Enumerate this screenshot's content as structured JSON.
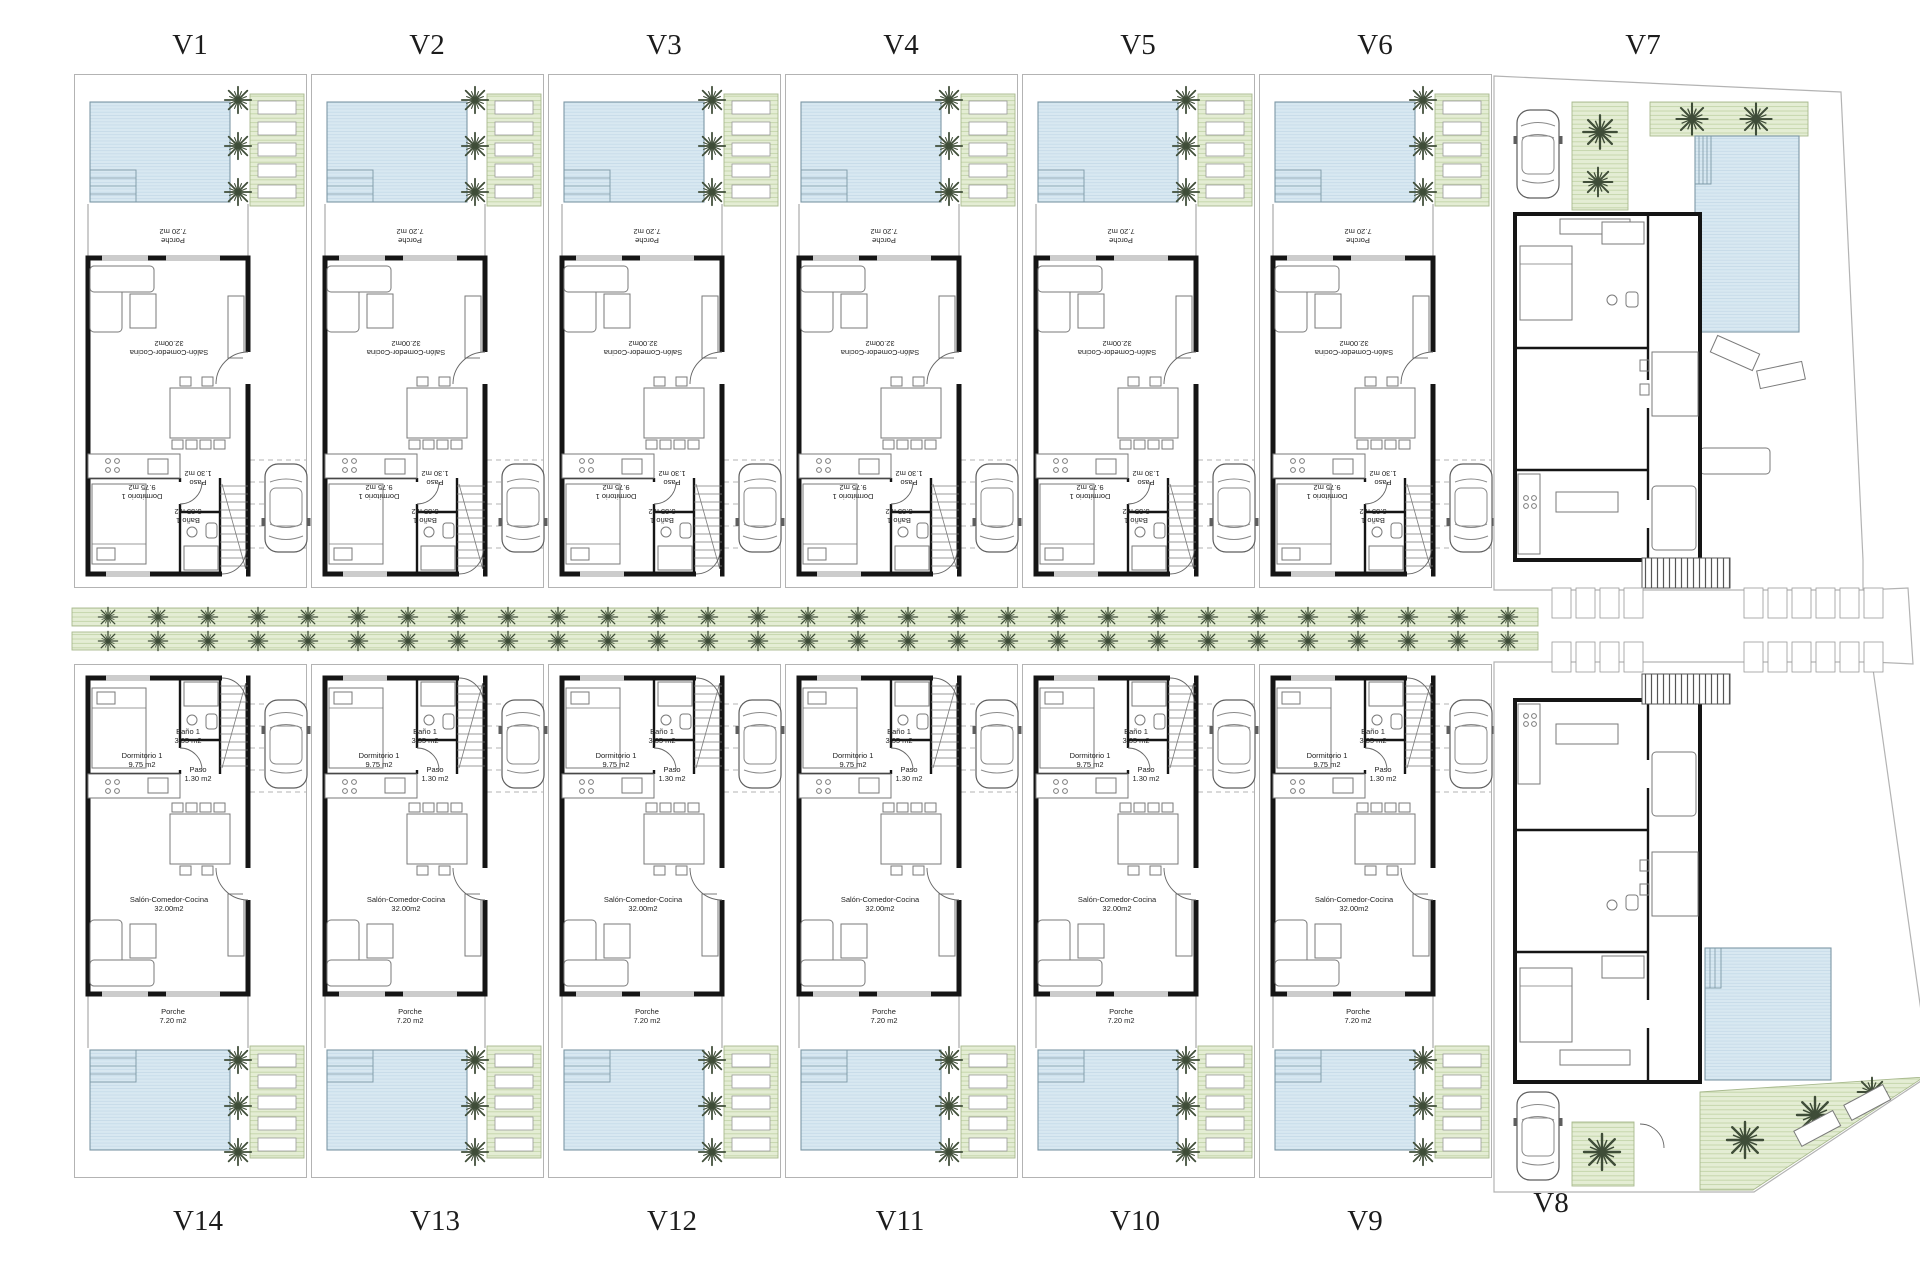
{
  "villas": {
    "top": [
      "V1",
      "V2",
      "V3",
      "V4",
      "V5",
      "V6",
      "V7"
    ],
    "bottom": [
      "V14",
      "V13",
      "V12",
      "V11",
      "V10",
      "V9",
      "V8"
    ]
  },
  "rooms": {
    "porche": {
      "name": "Porche",
      "area": "7.20 m2"
    },
    "salon": {
      "name": "Salón-Comedor-Cocina",
      "area": "32.00m2"
    },
    "dormitorio": {
      "name": "Dormitorio 1",
      "area": "9.75 m2"
    },
    "bano": {
      "name": "Baño 1",
      "area": "3.35 m2"
    },
    "paso": {
      "name": "Paso",
      "area": "1.30 m2"
    }
  },
  "colors": {
    "pool": "#d8e8f1",
    "pool_stripe": "#c3d9e7",
    "pool_border": "#7d98a6",
    "garden": "#e4edd4",
    "garden_stripe": "#bfd1a3",
    "garden_border": "#a8b98e",
    "wall": "#151515",
    "furniture_line": "#7a7a7a",
    "palm": "#3f4d38",
    "text": "#1c1c1c"
  }
}
